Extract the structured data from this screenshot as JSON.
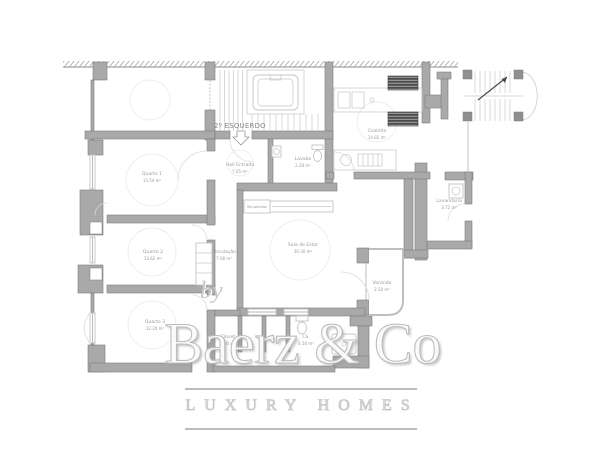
{
  "unit_label": "2º ESQUERDO",
  "rooms": {
    "quarto1": {
      "name": "Quarto 1",
      "area": "13.54 m²"
    },
    "quarto2": {
      "name": "Quarto 2",
      "area": "13.62 m²"
    },
    "quarto3": {
      "name": "Quarto 3",
      "area": "12.20 m²"
    },
    "circulacao": {
      "name": "Circulação",
      "area": "7.08 m²"
    },
    "sala": {
      "name": "Sala de Estar",
      "area": "30.30 m²"
    },
    "cozinha": {
      "name": "Cozinha",
      "area": "14.82 m²"
    },
    "hall": {
      "name": "Hall Entrada",
      "area": "7.05 m²"
    },
    "lavabo": {
      "name": "Lavabo",
      "area": "2.28 m²"
    },
    "lavandaria": {
      "name": "Lavandaria",
      "area": "3.72 m²"
    },
    "varanda": {
      "name": "Varanda",
      "area": "2.50 m²"
    },
    "closet": {
      "name": "Closet",
      "area": "6.20 m²"
    },
    "is": {
      "name": "I.S.",
      "area": "4.50 m²"
    },
    "recuperador": {
      "name": "Recuperador"
    }
  },
  "watermark": {
    "by": "by",
    "brand": "Baerz & Co",
    "tagline": "LUXURY HOMES"
  },
  "icons": {
    "elevator": "elevator-icon",
    "stairs": "stairs-icon",
    "exterior_stairs": "exterior-stairs-icon",
    "toilet": "toilet-icon",
    "sink": "sink-icon",
    "shower": "shower-icon",
    "washing_machine": "washing-machine-icon",
    "fireplace": "fireplace-icon",
    "wardrobe": "wardrobe-icon",
    "kitchen_counter": "kitchen-counter-icon",
    "entrance_arrow": "down-arrow-icon"
  },
  "colors": {
    "wall": "#a9a9a9",
    "wallstroke": "#7c7c7c",
    "thin": "#c3c3c3",
    "fixture": "#c5c5c5",
    "label": "#9a9a9a",
    "unitlabel": "#878787",
    "faint": "#ededed",
    "wmline": "#bcbcbc",
    "appliance": "#4a4a4a",
    "background": "#ffffff"
  }
}
